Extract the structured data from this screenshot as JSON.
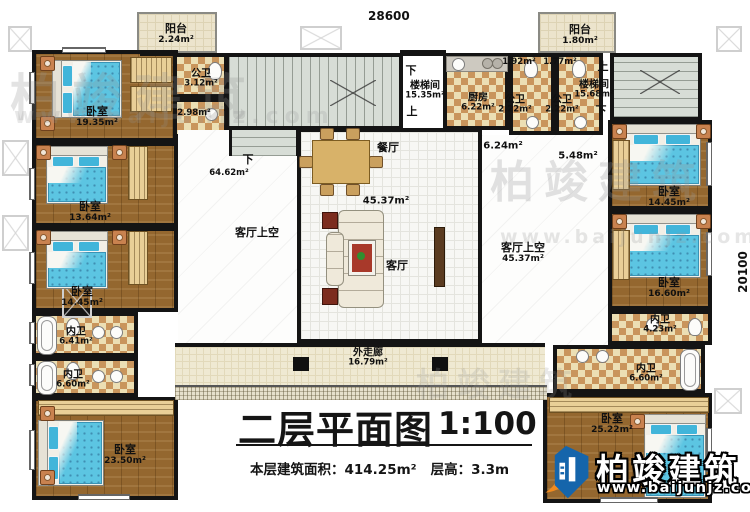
{
  "dimensions": {
    "top": "28600",
    "right": "20100"
  },
  "rooms": {
    "balcony_tl": {
      "name": "阳台",
      "area": "2.24m²"
    },
    "bedroom_l1": {
      "name": "卧室",
      "area": "19.35m²"
    },
    "bath_tl": {
      "name": "公卫",
      "area": "3.12m²"
    },
    "bath_tl2": {
      "area": "2.98m²"
    },
    "bedroom_l2": {
      "name": "卧室",
      "area": "13.64m²"
    },
    "bedroom_l3": {
      "name": "卧室",
      "area": "14.45m²"
    },
    "ensuite_l1": {
      "name": "内卫",
      "area": "6.41m²"
    },
    "ensuite_l2": {
      "name": "内卫",
      "area": "6.60m²"
    },
    "bedroom_l4": {
      "name": "卧室",
      "area": "23.50m²"
    },
    "stair_c": {
      "name": "楼梯间",
      "area": "15.35m²",
      "up": "上",
      "down": "下"
    },
    "void_l": {
      "name": "客厅上空",
      "area": "64.62m²",
      "down": "下"
    },
    "dining": {
      "name": "餐厅"
    },
    "living": {
      "name": "客厅",
      "area": "45.37m²"
    },
    "void_r": {
      "name": "客厅上空",
      "area": "45.37m²"
    },
    "hall_a": {
      "area": "6.24m²"
    },
    "hall_b": {
      "area": "5.48m²"
    },
    "kitchen": {
      "name": "厨房",
      "area": "6.22m²"
    },
    "bath_r1": {
      "name": "公卫",
      "area": "2.22m²",
      "sub": "1.92m²"
    },
    "bath_r2": {
      "name": "公卫",
      "area": "2.22m²",
      "sub": "1.77m²"
    },
    "balcony_tr": {
      "name": "阳台",
      "area": "1.80m²"
    },
    "stair_r": {
      "name": "楼梯间",
      "area": "15.68m²",
      "up": "上",
      "down": "下"
    },
    "bedroom_r1": {
      "name": "卧室",
      "area": "14.45m²"
    },
    "bedroom_r2": {
      "name": "卧室",
      "area": "16.60m²"
    },
    "ensuite_r1": {
      "name": "内卫",
      "area": "4.23m²"
    },
    "ensuite_r2": {
      "name": "内卫",
      "area": "6.60m²"
    },
    "bedroom_r3": {
      "name": "卧室",
      "area": "25.22m²"
    },
    "corridor": {
      "name": "外走廊",
      "area": "16.79m²"
    }
  },
  "title": {
    "main": "二层平面图",
    "scale": "1:100",
    "stats1": "本层建筑面积：414.25m²",
    "stats2": "层高：3.3m"
  },
  "logo": {
    "name": "柏竣建筑",
    "url": "www.baijunjz.com"
  },
  "watermark": {
    "text": "柏竣建筑",
    "url": "www.baijunjz.com"
  }
}
